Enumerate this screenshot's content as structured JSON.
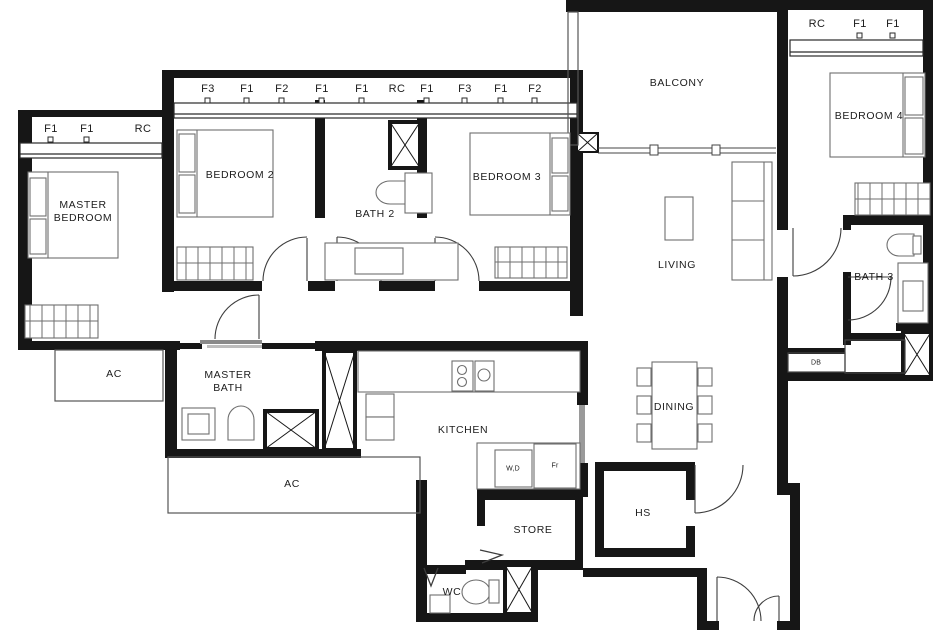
{
  "rooms": {
    "master_bedroom": "MASTER BEDROOM",
    "bedroom2": "BEDROOM 2",
    "bath2": "BATH 2",
    "bedroom3": "BEDROOM 3",
    "balcony": "BALCONY",
    "bedroom4": "BEDROOM 4",
    "living": "LIVING",
    "bath3": "BATH 3",
    "master_bath": "MASTER BATH",
    "ac_left": "AC",
    "kitchen": "KITCHEN",
    "dining": "DINING",
    "ac_bottom": "AC",
    "store": "STORE",
    "hs": "HS",
    "wc": "WC"
  },
  "appliances": {
    "washer_dryer": "W,D",
    "fridge": "Fr",
    "db": "DB"
  },
  "window_tags": {
    "master": [
      "F1",
      "F1",
      "RC"
    ],
    "top": [
      "F3",
      "F1",
      "F2",
      "F1",
      "F1",
      "RC",
      "F1",
      "F3",
      "F1",
      "F2"
    ],
    "bedroom4": [
      "RC",
      "F1",
      "F1"
    ]
  },
  "colors": {
    "wall": "#161616",
    "furniture": "#6e6e6e",
    "slider": "#8a8a8a"
  }
}
